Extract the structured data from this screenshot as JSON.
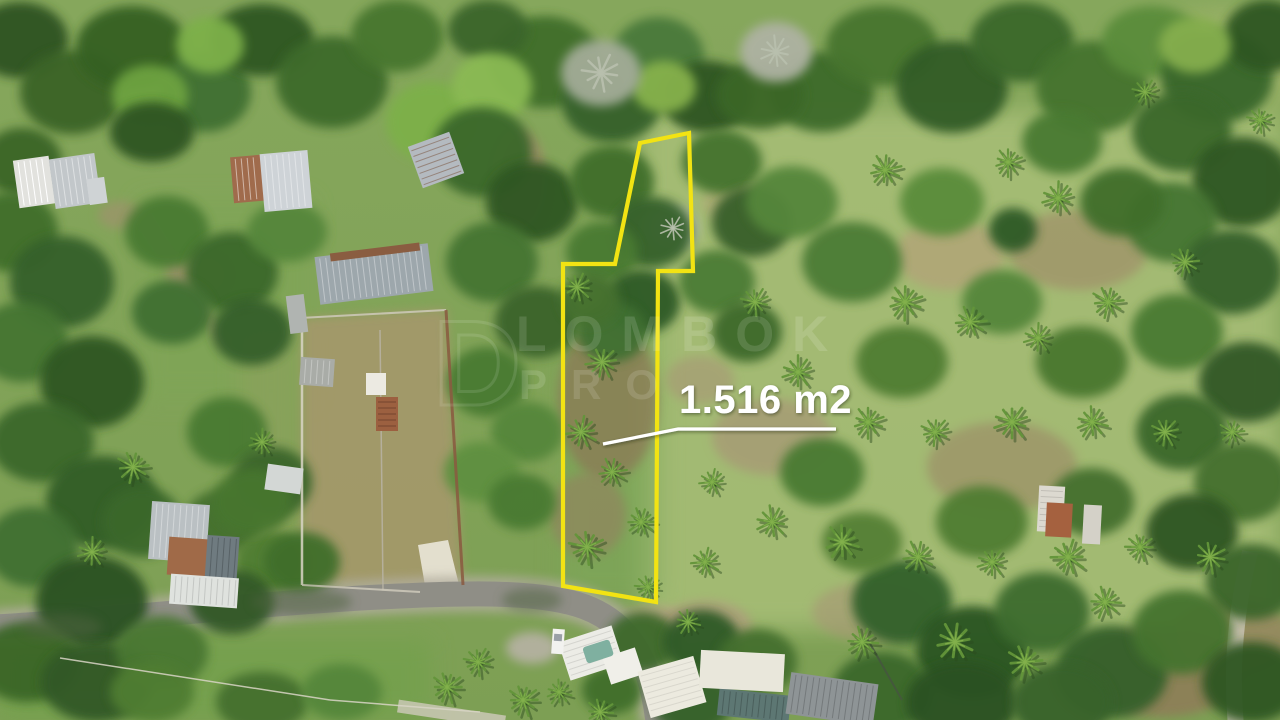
{
  "scene": {
    "kind": "aerial-drone-photo",
    "subject": "land plot outlined for sale"
  },
  "annotation": {
    "area_label": "1.516 m2",
    "label_color": "#ffffff",
    "outline_color": "#f2e313",
    "plot_outline_points": "640,143 689,133 693,271 658,271 656,602 563,586 563,264 615,264",
    "connector_points": "836,429 678,429 603,444"
  },
  "watermark": {
    "monogram": "D",
    "row1": "LOMBOK",
    "row2": "PRO",
    "color": "#ffffff"
  },
  "palette": {
    "canopy_dark": "#2f5322",
    "meadow_light": "#a9bf78",
    "dirt": "#9c8b66",
    "road": "#8f8e86",
    "roof_metal": "#c2c7ca",
    "roof_rust": "#a06b4c",
    "pool": "#7fb0a0"
  }
}
